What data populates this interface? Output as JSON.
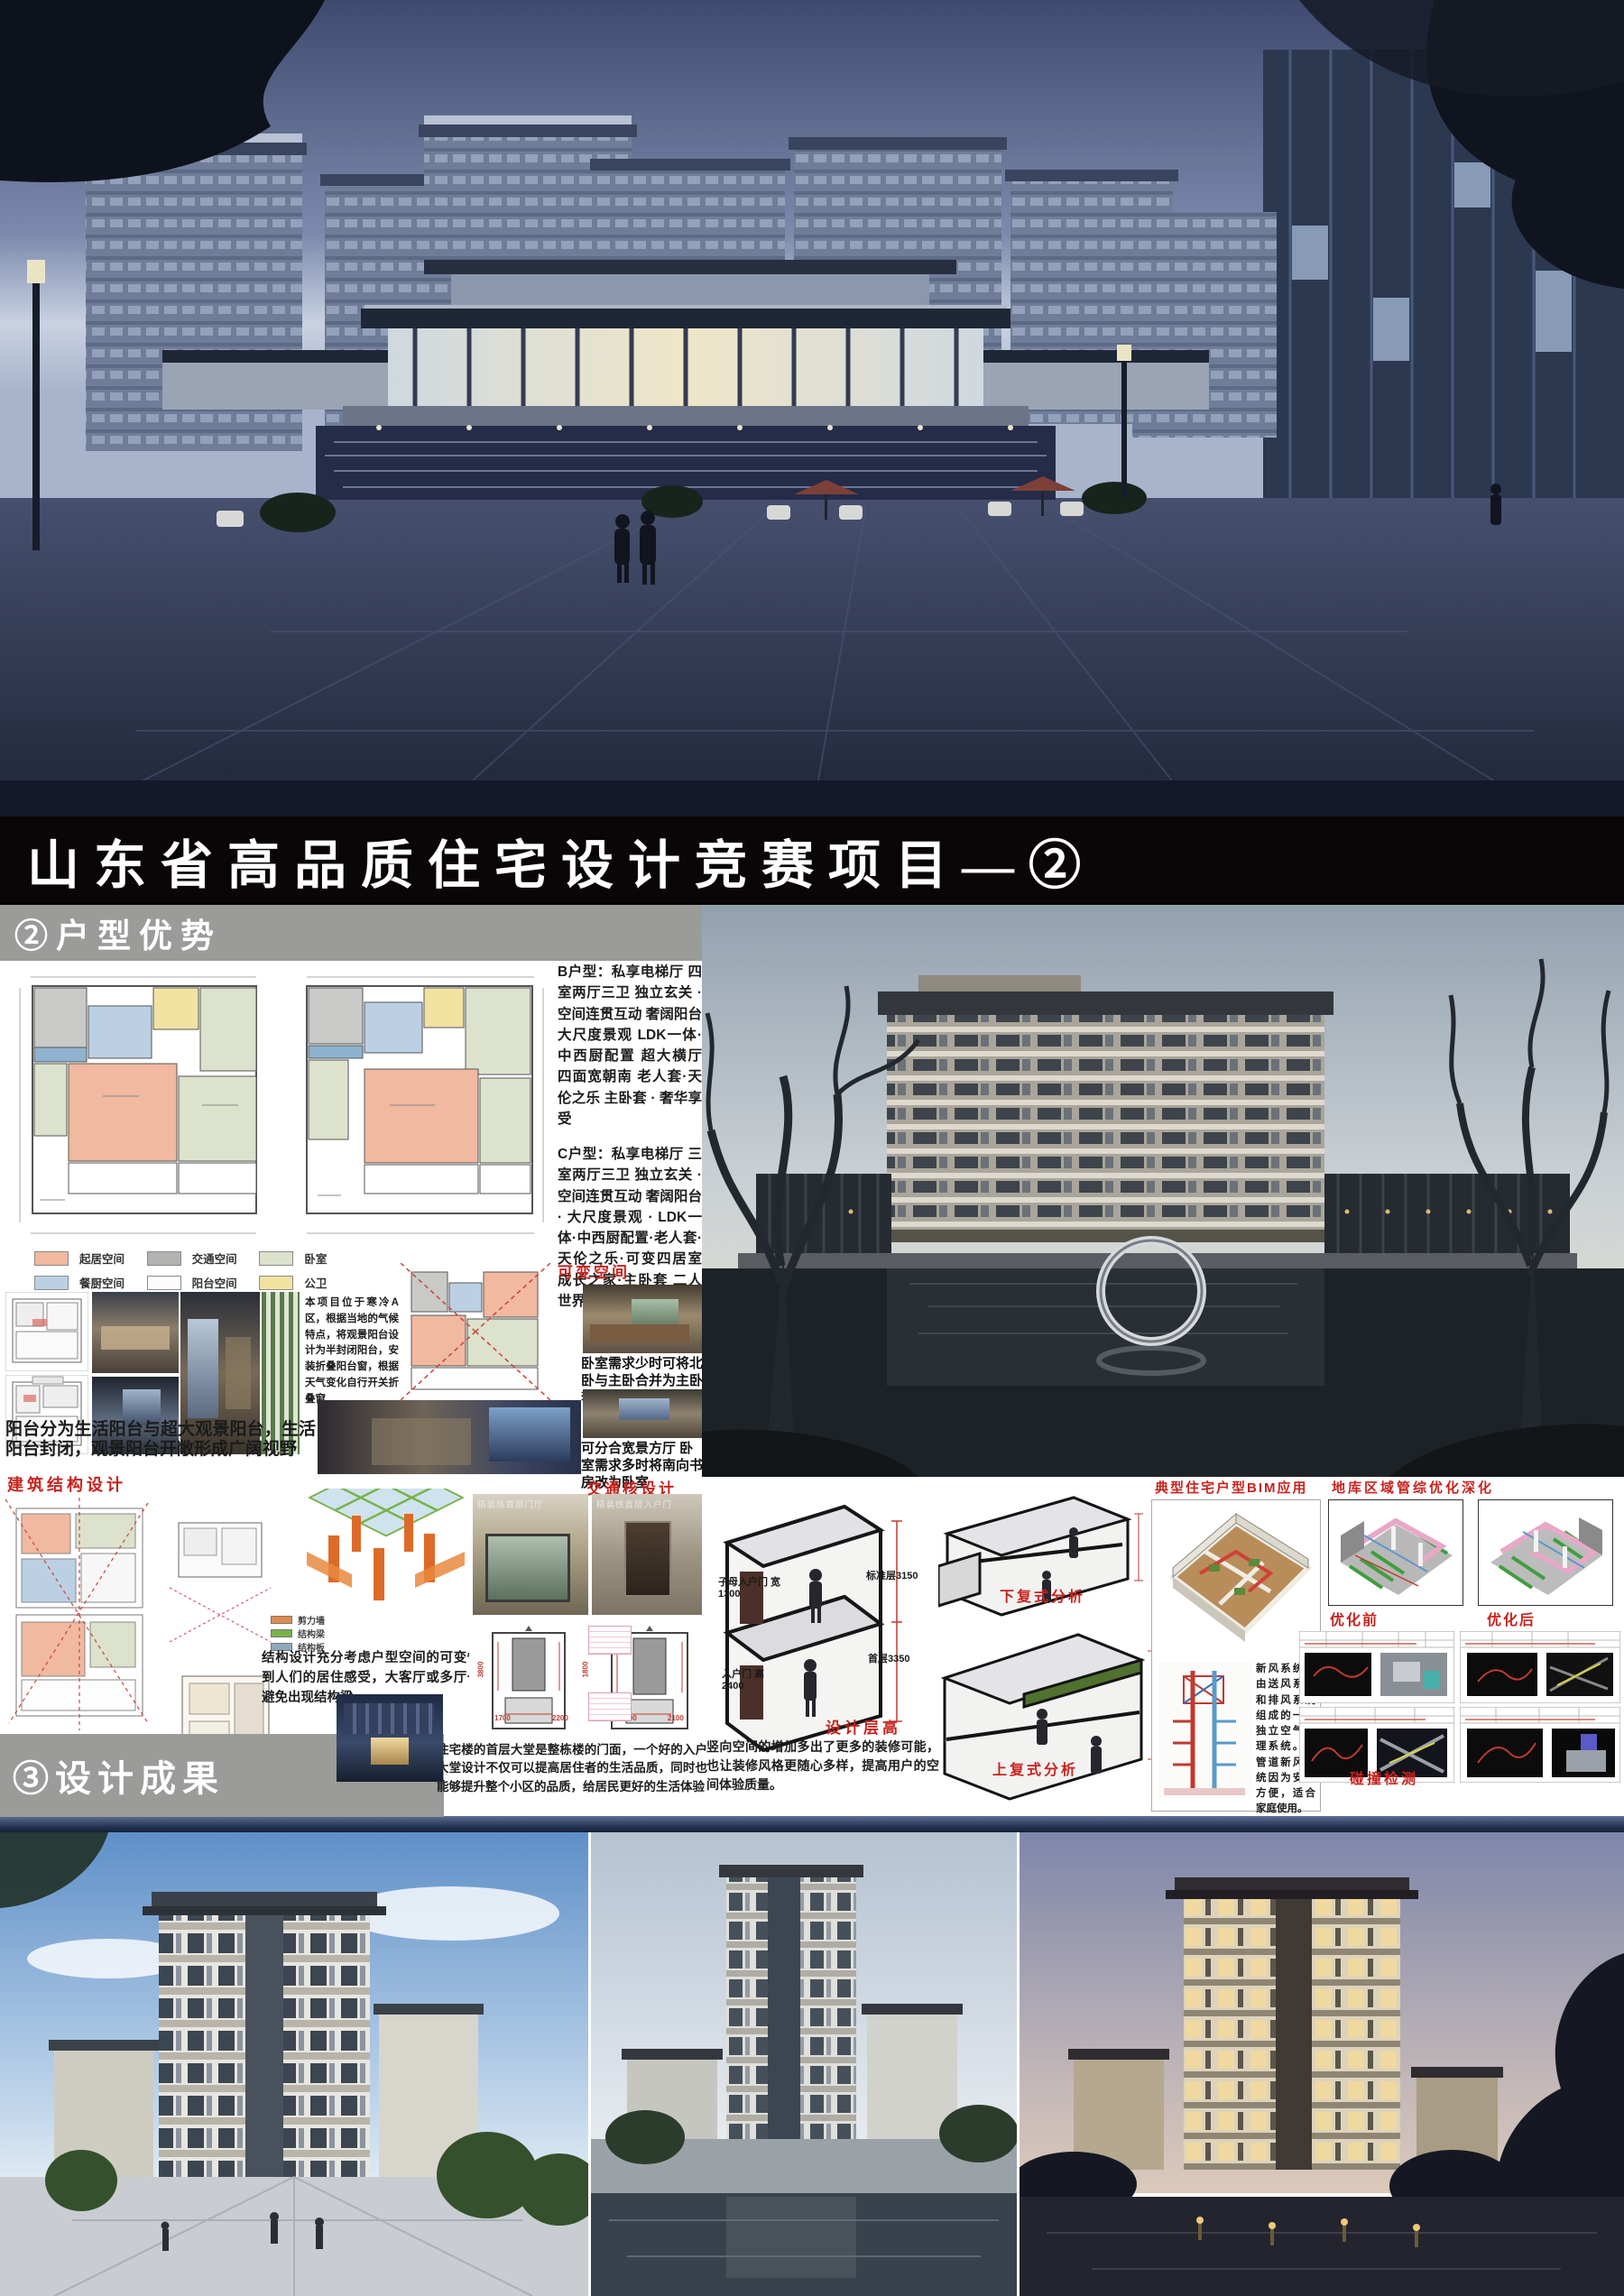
{
  "poster": {
    "title": "山东省高品质住宅设计竞赛项目—②"
  },
  "colors": {
    "accent_red": "#c8231e",
    "section_bar_gray": "#9b9b99",
    "title_bar_black": "#0a0607"
  },
  "huxing": {
    "header": "②户型优势",
    "b_type_label": "B户型：",
    "b_type_text": "私享电梯厅 四室两厅三卫 独立玄关 · 空间连贯互动 奢阔阳台 大尺度景观 LDK一体·中西厨配置 超大横厅 四面宽朝南 老人套·天伦之乐 主卧套 · 奢华享受",
    "c_type_label": "C户型：",
    "c_type_text": "私享电梯厅 三室两厅三卫 独立玄关 · 空间连贯互动 奢阔阳台 · 大尺度景观 · LDK一体·中西厨配置·老人套·天伦之乐·可变四居室 成长之家·主卧套 二人世界",
    "legend": [
      {
        "label": "起居空间",
        "color": "#f0b9a0"
      },
      {
        "label": "交通空间",
        "color": "#b3b3b1"
      },
      {
        "label": "卧室",
        "color": "#dce2cc"
      },
      {
        "label": "餐厨空间",
        "color": "#bcd0e4"
      },
      {
        "label": "阳台空间",
        "color": "#fdfdfd"
      },
      {
        "label": "公卫",
        "color": "#f2e2a2"
      }
    ],
    "variable_space_title": "可变空间",
    "climate_text": "本项目位于寒冷A区，根据当地的气候特点，将观景阳台设计为半封闭阳台，安装折叠阳台窗，根据天气变化自行开关折叠窗",
    "caption_merge": "卧室需求少时可将北卧与主卧合并为主卧套房",
    "caption_split": "可分合宽景方厅 卧室需求多时将南向书房改为卧室",
    "balcony_text": {
      "p1": "阳台分为",
      "red1": "生活阳台",
      "p2": "与",
      "red2": "超大观景阳台",
      "p3": "，生活阳台封闭，观景阳台开敞形成广阔视野"
    }
  },
  "structure": {
    "title": "建筑结构设计",
    "legend": [
      {
        "label": "剪力墙",
        "color": "#de8a50"
      },
      {
        "label": "结构梁",
        "color": "#79b34a"
      },
      {
        "label": "结构板",
        "color": "#8ea8bd"
      }
    ],
    "text": "结构设计充分考虑户型空间的可变性。考虑到人们的居住感受，大客厅或多厅一体空间避免出现结构梁。"
  },
  "core": {
    "title": "交通核设计",
    "photo1_caption": "精装核首层门厅",
    "photo2_caption": "精装核直层入户门",
    "dims": [
      "3800",
      "1800",
      "1700",
      "2200",
      "2500",
      "2100"
    ],
    "lobby_text": "住宅楼的首层大堂是整栋楼的门面，一个好的入户大堂设计不仅可以提高居住者的生活品质，同时也能够提升整个小区的品质，给居民更好的生活体验"
  },
  "floor_height": {
    "title": "设计层高",
    "door_pair_label": "子母入户门 宽1300",
    "entry_door_label": "入户门 高2400",
    "std_floor_label": "标准层3150",
    "first_floor_label": "首层3350",
    "text": "竖向空间的增加多出了更多的装修可能，也让装修风格更随心多样，提高用户的空间体验质量。"
  },
  "duplex": {
    "lower_label": "下复式分析",
    "upper_label": "上复式分析"
  },
  "bim": {
    "title": "典型住宅户型BIM应用",
    "fresh_air_red": "新风系统",
    "fresh_air_text": "是由送风系统和排风系统组成的一套独立空气处理系统。无管道新风系统因为安装方便，适合家庭使用。"
  },
  "garage": {
    "title": "地库区域管综优化深化",
    "before_label": "优化前",
    "after_label": "优化后",
    "clash_label": "碰撞检测"
  },
  "results": {
    "header": "③设计成果"
  }
}
